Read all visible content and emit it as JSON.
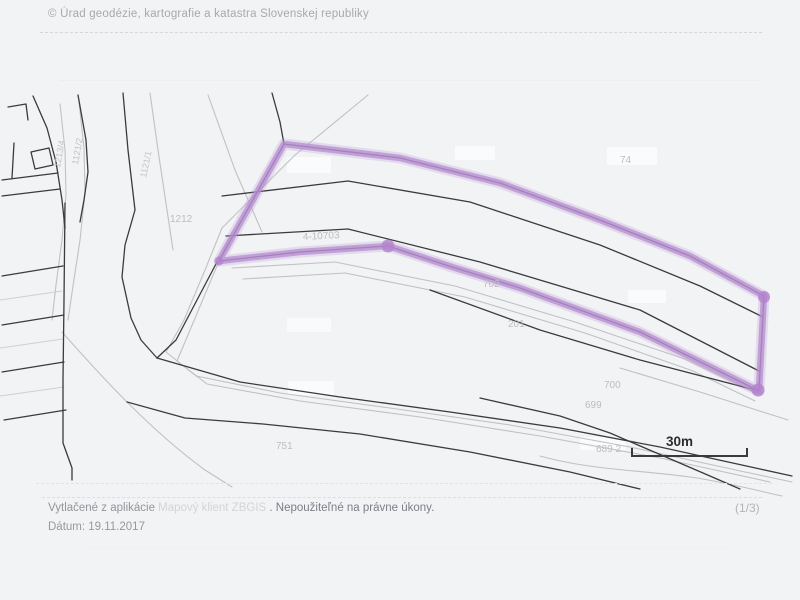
{
  "header": {
    "copyright": "© Úrad geodézie, kartografie a katastra Slovenskej republiky"
  },
  "footer": {
    "printed_prefix": "Vytlačené z aplikácie",
    "app_name": "Mapový klient ZBGIS",
    "printed_suffix": ". Nepoužiteľné na právne úkony.",
    "date_label": "Dátum: 19.11.2017",
    "page_indicator": "(1/3)"
  },
  "map": {
    "type": "cadastral-parcel-map-scan",
    "highlight_color": "#b78fd2",
    "scale_bar": {
      "label": "30m"
    },
    "parcel_labels": [
      {
        "id": "l1212",
        "text": "1212"
      },
      {
        "id": "l1121_1",
        "text": "1121/1"
      },
      {
        "id": "l1213_4",
        "text": "1213/4"
      },
      {
        "id": "l1121_2",
        "text": "1121/2"
      },
      {
        "id": "l4_10703",
        "text": "4-10703"
      },
      {
        "id": "l702",
        "text": "702"
      },
      {
        "id": "l201",
        "text": "201"
      },
      {
        "id": "l74",
        "text": "74"
      },
      {
        "id": "l700",
        "text": "700"
      },
      {
        "id": "l699",
        "text": "699"
      },
      {
        "id": "l689_2",
        "text": "689 2"
      },
      {
        "id": "l751",
        "text": "751"
      }
    ]
  }
}
